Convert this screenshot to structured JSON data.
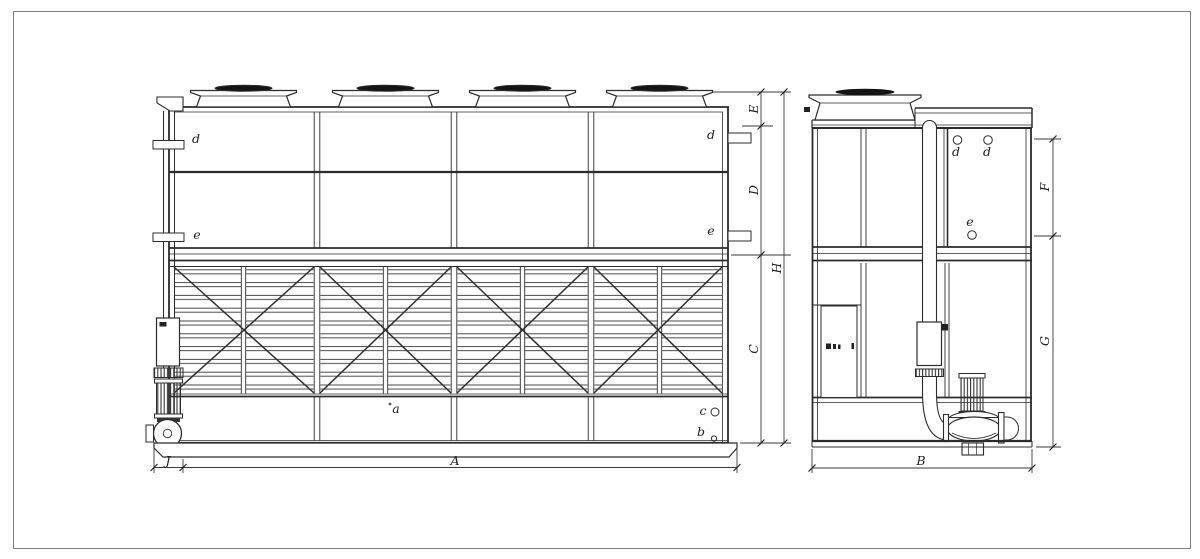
{
  "labels": {
    "dim_A": "A",
    "dim_B": "B",
    "dim_C": "C",
    "dim_D": "D",
    "dim_E": "E",
    "dim_F": "F",
    "dim_G": "G",
    "dim_H": "H",
    "dim_J": "J",
    "front_d_left": "d",
    "front_d_right": "d",
    "front_e_left": "e",
    "front_e_right": "e",
    "front_a": "a",
    "front_b": "b",
    "front_c": "c",
    "side_d_1": "d",
    "side_d_2": "d",
    "side_e": "e"
  },
  "colors": {
    "line": "#2b2b2b",
    "fan_blade": "#141414",
    "background": "#ffffff",
    "frame_border": "#7d7d7d"
  }
}
